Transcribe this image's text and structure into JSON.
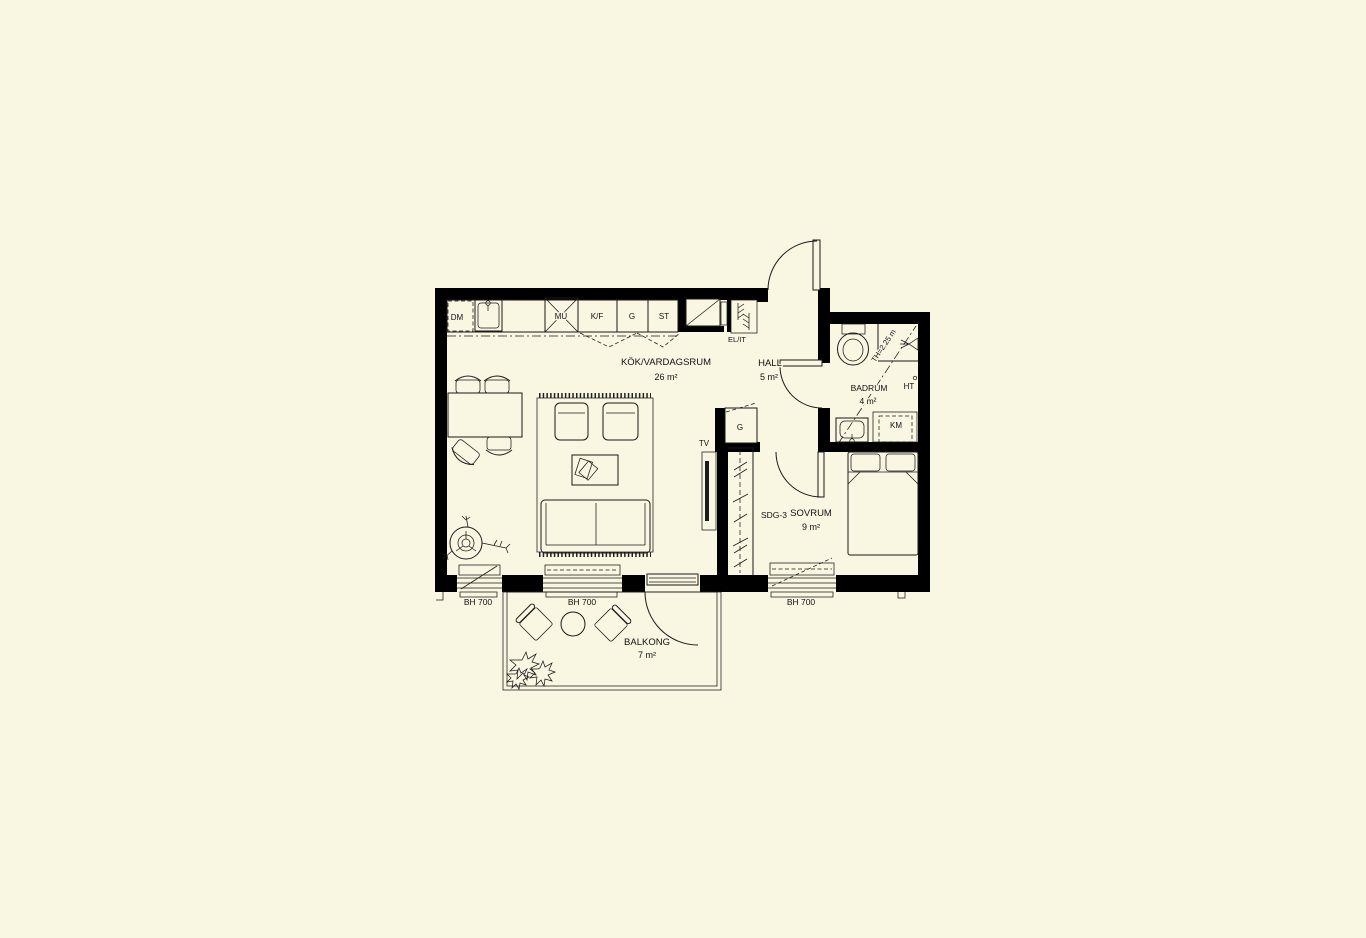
{
  "colors": {
    "background": "#f9f6e2",
    "line": "#111111"
  },
  "rooms": {
    "kitchen_living": {
      "name": "KÖK/VARDAGSRUM",
      "area": "26 m²"
    },
    "hall": {
      "name": "HALL",
      "area": "5 m²"
    },
    "bathroom": {
      "name": "BADRUM",
      "area": "4 m²"
    },
    "bedroom": {
      "name": "SOVRUM",
      "area": "9 m²"
    },
    "balcony": {
      "name": "BALKONG",
      "area": "7 m²"
    }
  },
  "labels": {
    "dishwasher": "DM",
    "microwave": "MU",
    "fridge_freezer": "K/F",
    "kitchen_tall_cabinet": "G",
    "cleaning_cabinet": "ST",
    "el_it_cabinet": "EL/IT",
    "tv": "TV",
    "hall_wardrobe": "G",
    "sliding_glass_door": "SDG-3",
    "washing_machine": "KM",
    "towel_dryer": "HT",
    "ceiling_height": "TH=2.25 m",
    "window_sill_height_1": "BH 700",
    "window_sill_height_2": "BH 700",
    "window_sill_height_3": "BH 700"
  }
}
